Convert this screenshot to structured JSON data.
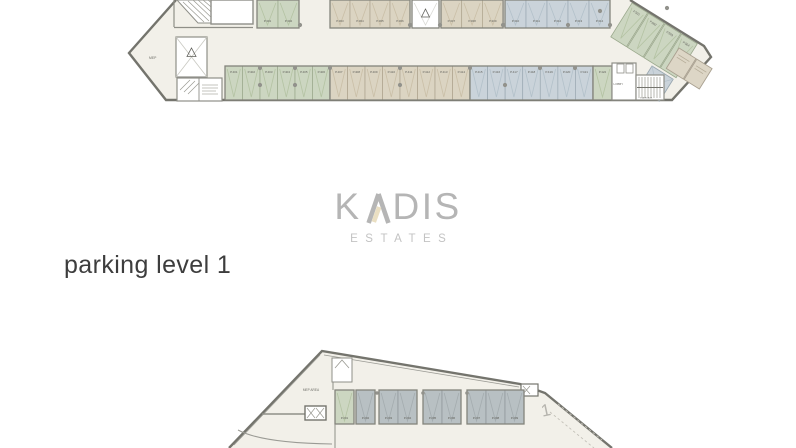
{
  "logo": {
    "brand_left": "K",
    "brand_right": "DIS",
    "brand_full": "KADIS",
    "subtitle": "ESTATES"
  },
  "caption": {
    "text": "parking level 1"
  },
  "colors": {
    "floor": "#f2f0e9",
    "wall": "#74746d",
    "inner_wall": "#8f8f88",
    "column_dot": "#92928c",
    "logo_gray": "#b5b5b5",
    "logo_accent": "#eadfc2",
    "estates_gray": "#c3c3c3",
    "caption_text": "#3d3d3d",
    "stalls": {
      "green": {
        "fill": "#ccd6c1",
        "stroke": "#9aa88c",
        "pattern": "#b4c3a3"
      },
      "beige": {
        "fill": "#dbd4c2",
        "stroke": "#ada38d",
        "pattern": "#cabfa7"
      },
      "blue": {
        "fill": "#cad3da",
        "stroke": "#9aa8b1",
        "pattern": "#b3c1ca"
      },
      "gray": {
        "fill": "#b8c0c3",
        "stroke": "#8d9598",
        "pattern": "#a4acaf"
      },
      "white": {
        "fill": "#ffffff",
        "stroke": "#8a8a84",
        "pattern": "#d9d9d4"
      }
    }
  },
  "top_plan": {
    "mep_label": "MEP",
    "lobby_label": "LOBBY",
    "staircase_label": "STAIRCASE",
    "rows": [
      {
        "name": "upper",
        "y": 0,
        "h": 28,
        "label_dy": 22,
        "groups": [
          {
            "x": 257,
            "w": 21,
            "color": "green",
            "labels": [
              "P.301",
              "P.302"
            ]
          },
          {
            "x": 330,
            "w": 20,
            "color": "beige",
            "labels": [
              "P.303",
              "P.304",
              "P.305",
              "P.306"
            ]
          },
          {
            "x": 412,
            "w": 27,
            "color": "white",
            "labels": [
              ""
            ]
          },
          {
            "x": 441,
            "w": 20.7,
            "color": "beige",
            "labels": [
              "P.307",
              "P.308",
              "P.309"
            ]
          },
          {
            "x": 505,
            "w": 21,
            "color": "blue",
            "labels": [
              "P.310",
              "P.311",
              "P.312",
              "P.313",
              "P.314"
            ]
          }
        ]
      },
      {
        "name": "lower",
        "y": 66,
        "h": 34,
        "label_dy": 7,
        "groups": [
          {
            "x": 225,
            "w": 17.5,
            "color": "green",
            "labels": [
              "P.401",
              "P.402",
              "P.403",
              "P.404",
              "P.405",
              "P.406"
            ]
          },
          {
            "x": 330,
            "w": 17.5,
            "color": "beige",
            "labels": [
              "P.407",
              "P.408",
              "P.409",
              "P.410",
              "P.411",
              "P.412",
              "P.413",
              "P.414"
            ]
          },
          {
            "x": 470,
            "w": 17.57,
            "color": "blue",
            "labels": [
              "P.415",
              "P.416",
              "P.417",
              "P.418",
              "P.419",
              "P.420",
              "P.421"
            ]
          },
          {
            "x": 593,
            "w": 19,
            "color": "green",
            "labels": [
              "P.422"
            ]
          }
        ]
      }
    ],
    "diagonal_labels": [
      "P.501",
      "P.502",
      "P.503",
      "P.504"
    ]
  },
  "bottom_plan": {
    "mep_area_label": "MEP AREA",
    "ramp_number": "1",
    "row": {
      "y": 46,
      "h": 34,
      "label_dy": 29,
      "groups": [
        {
          "x": 335,
          "w": 19,
          "color": "green",
          "labels": [
            "P.201"
          ]
        },
        {
          "x": 356,
          "w": 19,
          "color": "gray",
          "labels": [
            "P.202"
          ]
        },
        {
          "x": 379,
          "w": 19,
          "color": "gray",
          "labels": [
            "P.203",
            "P.204"
          ]
        },
        {
          "x": 423,
          "w": 19,
          "color": "gray",
          "labels": [
            "P.205",
            "P.206"
          ]
        },
        {
          "x": 467,
          "w": 19,
          "color": "gray",
          "labels": [
            "P.207",
            "P.208",
            "P.209"
          ]
        }
      ]
    }
  }
}
